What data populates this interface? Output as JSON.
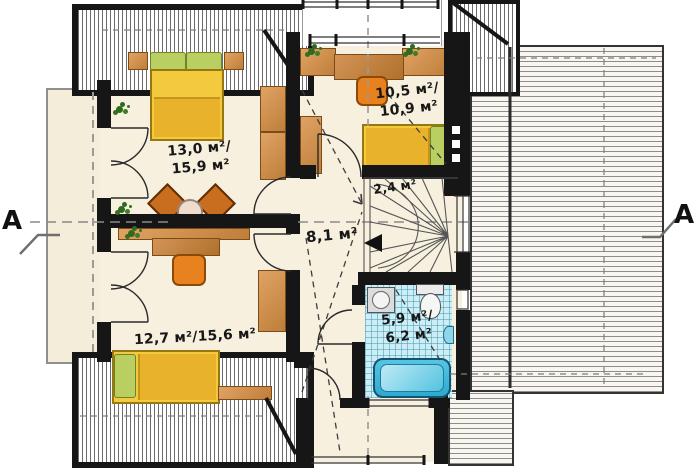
{
  "section_markers": {
    "left": "A",
    "right": "A"
  },
  "rooms": {
    "bedroom_top_left": {
      "area": "13,0 м²/",
      "area2": "15,9 м²"
    },
    "bedroom_top_center": {
      "area": "10,5 м²/",
      "area2": "10,9 м²"
    },
    "stair_closet": {
      "area": "2,4 м²"
    },
    "hall": {
      "area": "8,1 м²"
    },
    "bathroom": {
      "area": "5,9 м²/",
      "area2": "6,2 м²"
    },
    "bedroom_bottom_left": {
      "area": "12,7 м²/15,6 м²"
    }
  },
  "colors": {
    "wall": "#161616",
    "floor": "#f7f0de",
    "bath_tile": "#cdeef6",
    "bathtub": "#2fa9cf",
    "bed": "#f3ca3e",
    "furniture_wood": "#c98a4b",
    "chair": "#e8821f",
    "pillow": "#b9cf62"
  }
}
